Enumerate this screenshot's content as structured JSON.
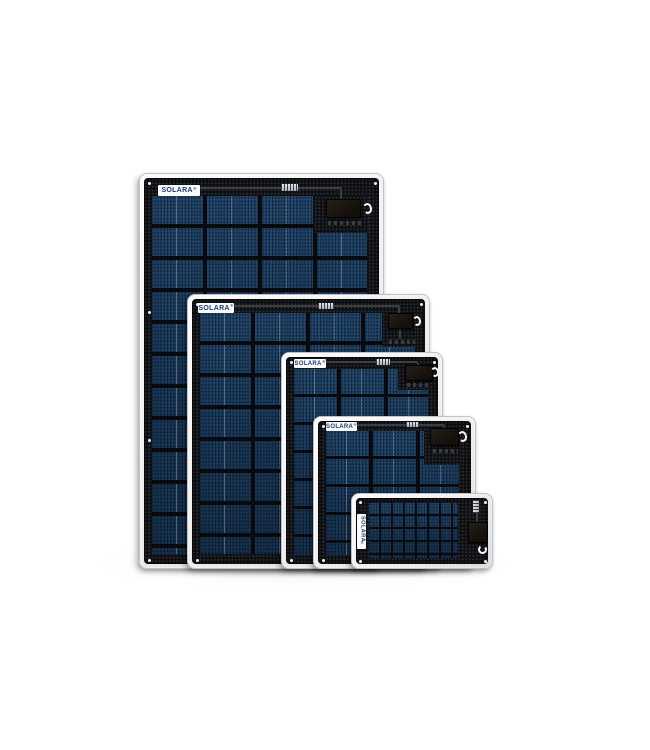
{
  "image": {
    "kind": "product-photo",
    "subject": "Five SOLARA flexible solar panels of descending size, overlapped and bottom-aligned on a white background",
    "background_color": "#ffffff"
  },
  "brand": {
    "name": "SOLARA",
    "registered_mark": "®",
    "logo_text_color": "#1b3c74",
    "logo_background": "#fafbfc"
  },
  "colors": {
    "panel_frame": "#ededee",
    "panel_surface": "#0e0f12",
    "solar_cell_blue": "#1d3f63",
    "junction_box": "#1a140f",
    "barcode_sticker": "#c9cdd2",
    "cable_loop": "#f5f6f7"
  },
  "panels": [
    {
      "id": "panel-1",
      "logo": "SOLARA",
      "orientation": "portrait",
      "size_rank": "largest",
      "features": [
        "logo-sticker",
        "barcode-sticker",
        "junction-box",
        "cable-loop",
        "mounting-holes"
      ]
    },
    {
      "id": "panel-2",
      "logo": "SOLARA",
      "orientation": "portrait",
      "size_rank": "second",
      "features": [
        "logo-sticker",
        "barcode-sticker",
        "junction-box",
        "cable-loop",
        "mounting-holes"
      ]
    },
    {
      "id": "panel-3",
      "logo": "SOLARA",
      "orientation": "portrait",
      "size_rank": "third",
      "features": [
        "logo-sticker",
        "barcode-sticker",
        "junction-box",
        "cable-loop",
        "mounting-holes"
      ]
    },
    {
      "id": "panel-4",
      "logo": "SOLARA",
      "orientation": "landscape",
      "size_rank": "fourth",
      "features": [
        "logo-sticker",
        "barcode-sticker",
        "junction-box",
        "cable-loop",
        "mounting-holes"
      ]
    },
    {
      "id": "panel-5",
      "logo": "SOLARA",
      "orientation": "landscape",
      "size_rank": "smallest",
      "features": [
        "vertical-logo-sticker",
        "barcode-sticker",
        "junction-box",
        "cable-loop",
        "mounting-holes"
      ]
    }
  ]
}
